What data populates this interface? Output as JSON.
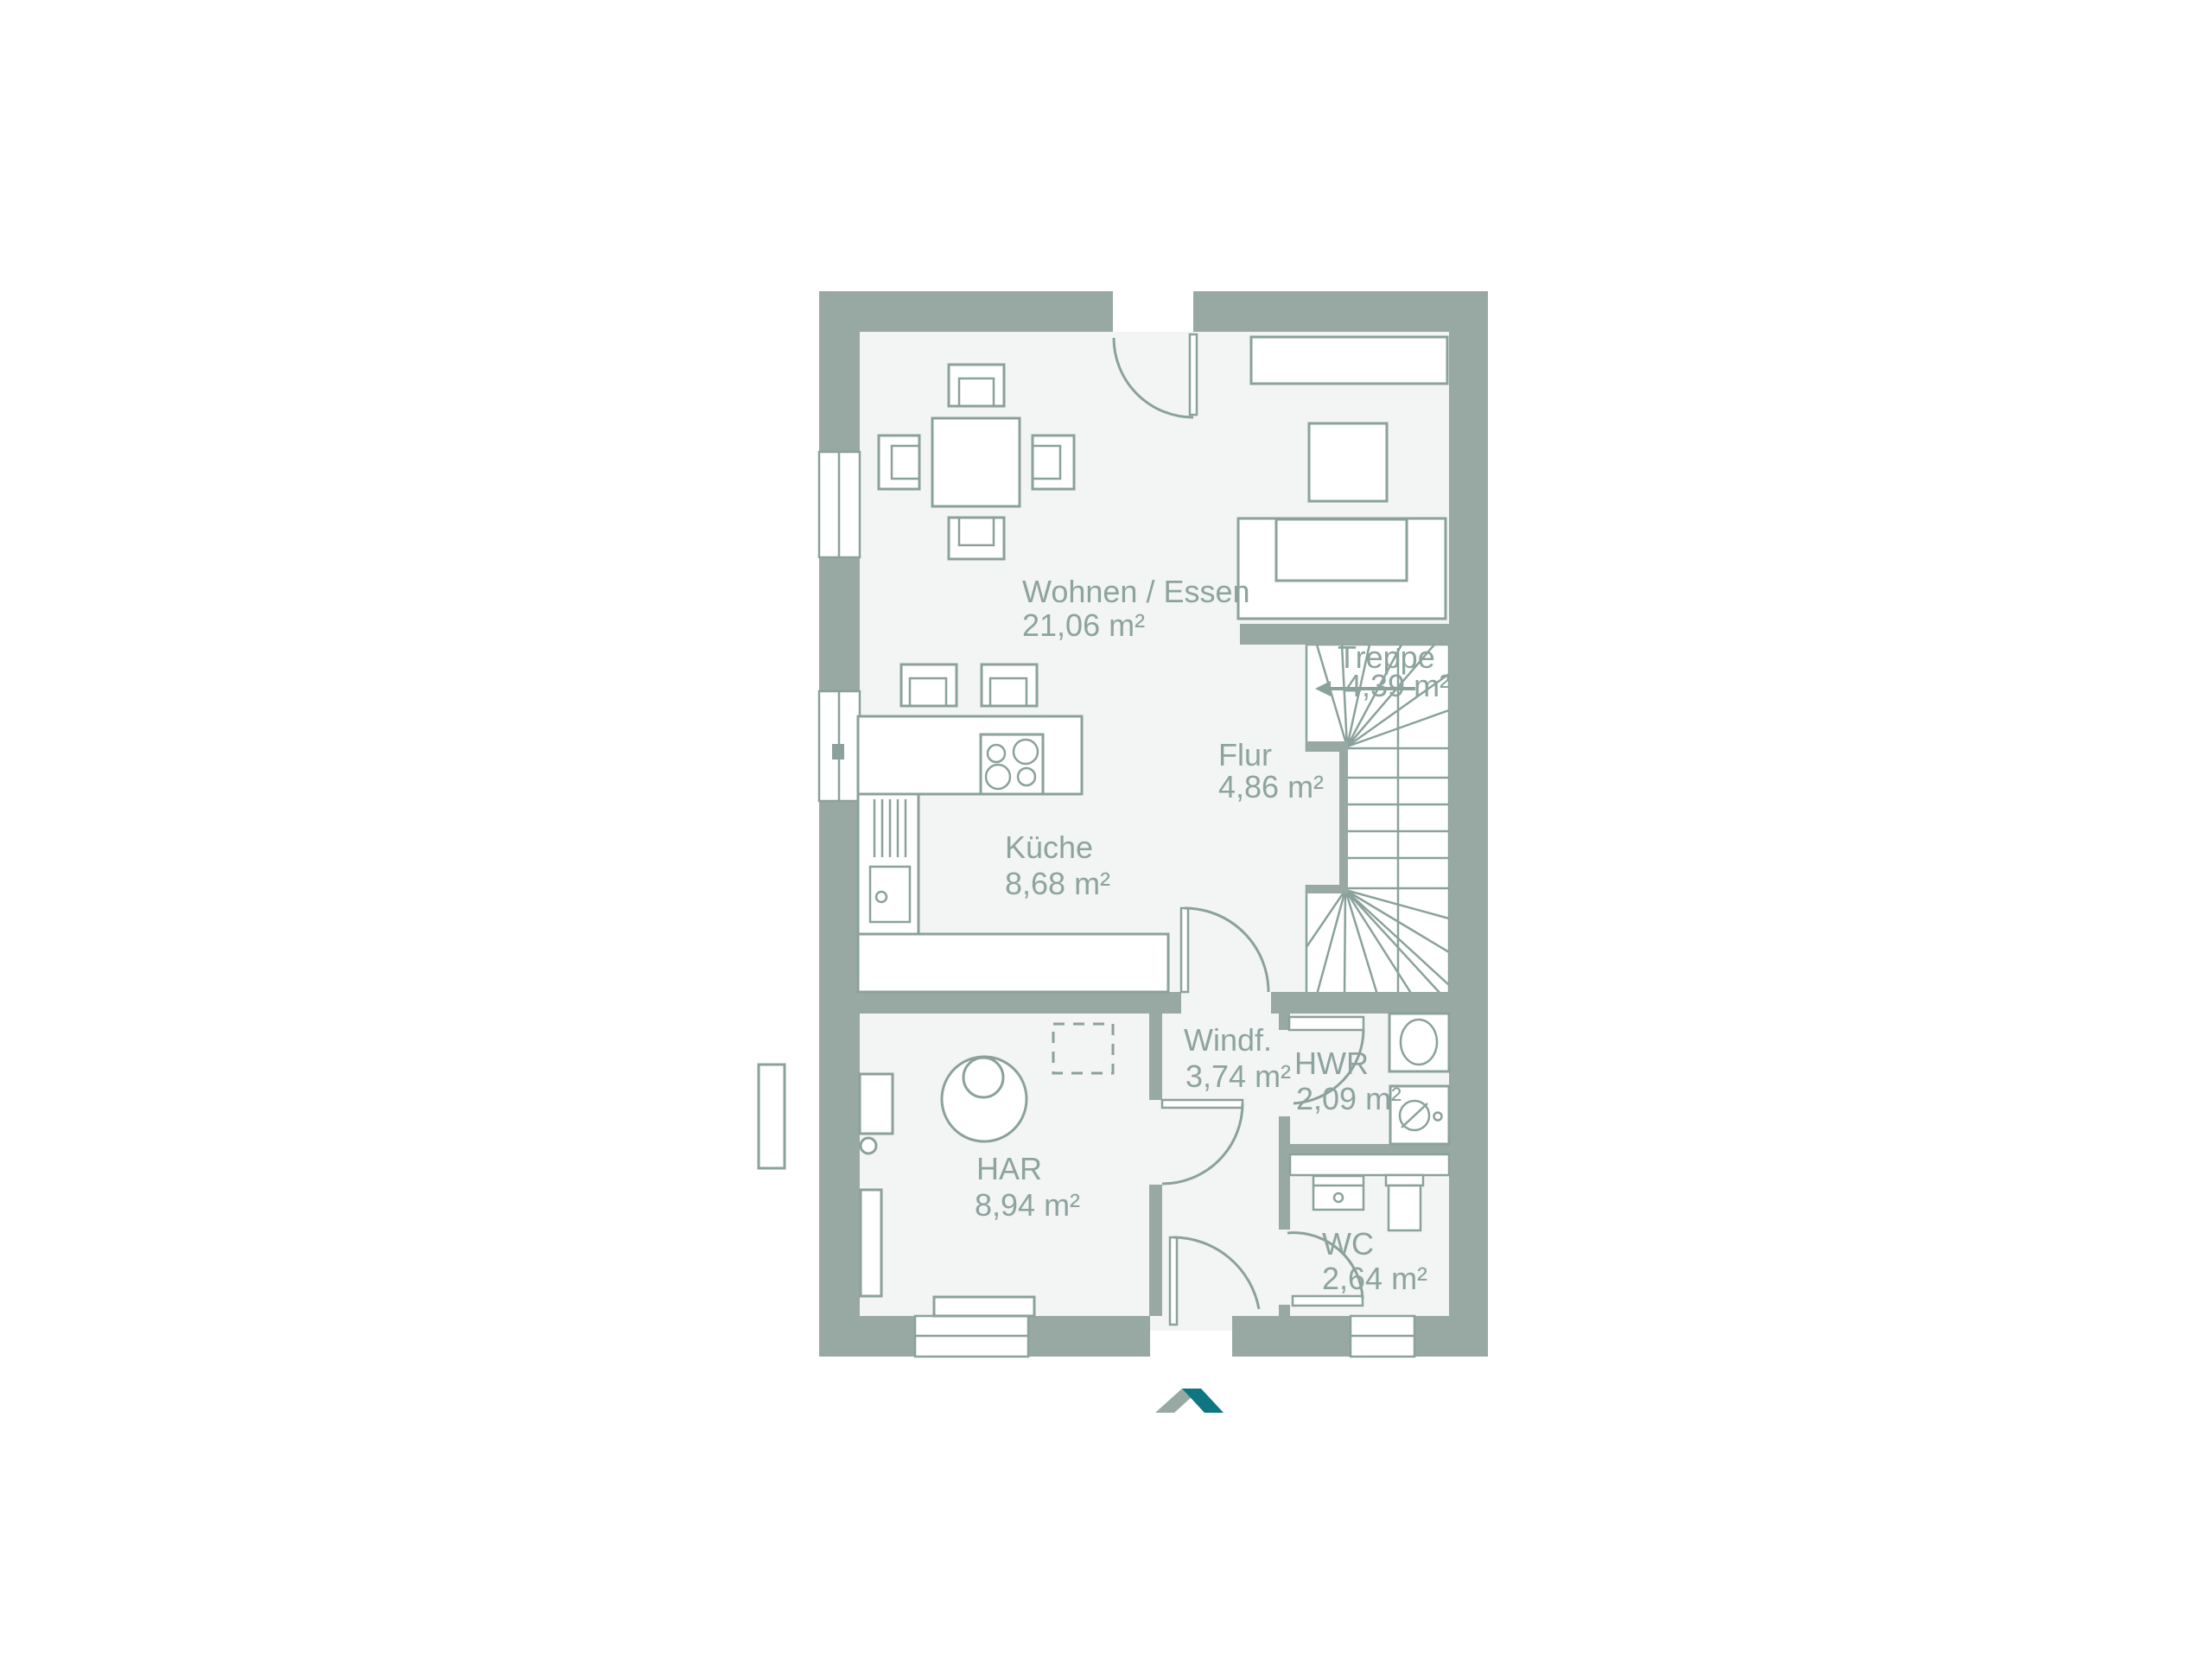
{
  "plan": {
    "title_hidden": "",
    "rooms": [
      {
        "name": "wohnen-essen",
        "label": "Wohnen / Essen",
        "area": "21,06 m²"
      },
      {
        "name": "kueche",
        "label": "Küche",
        "area": "8,68 m²"
      },
      {
        "name": "flur",
        "label": "Flur",
        "area": "4,86 m²"
      },
      {
        "name": "treppe",
        "label": "Treppe",
        "area": "4,39 m²"
      },
      {
        "name": "windfang",
        "label": "Windf.",
        "area": "3,74 m²"
      },
      {
        "name": "hwr",
        "label": "HWR",
        "area": "2,09 m²"
      },
      {
        "name": "har",
        "label": "HAR",
        "area": "8,94 m²"
      },
      {
        "name": "wc",
        "label": "WC",
        "area": "2,64 m²"
      }
    ],
    "colors": {
      "wall": "#98a9a3",
      "floor": "#f3f4f4",
      "line": "#8ba19b",
      "text": "#8da49e",
      "logo_teal": "#0d7680",
      "logo_gray": "#98a9a3"
    },
    "icons": [
      "roof-logo"
    ]
  }
}
